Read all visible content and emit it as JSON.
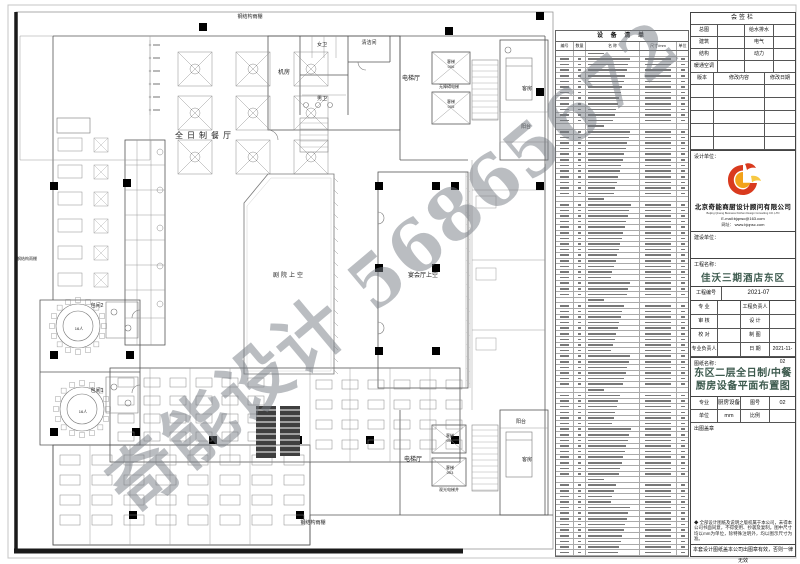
{
  "sheet": {
    "watermark": "奇能设计 56865672"
  },
  "plan": {
    "labels": [
      {
        "t": "钢结构雨棚",
        "x": 250,
        "y": 18,
        "s": 5
      },
      {
        "t": "全日制餐厅",
        "x": 205,
        "y": 138,
        "s": 8,
        "ls": 4
      },
      {
        "t": "机房",
        "x": 284,
        "y": 74,
        "s": 6
      },
      {
        "t": "女卫",
        "x": 322,
        "y": 46,
        "s": 5
      },
      {
        "t": "男卫",
        "x": 322,
        "y": 100,
        "s": 5
      },
      {
        "t": "清洁间",
        "x": 369,
        "y": 44,
        "s": 5
      },
      {
        "t": "电梯厅",
        "x": 411,
        "y": 80,
        "s": 6
      },
      {
        "t": "客梯",
        "x": 451,
        "y": 63,
        "s": 4
      },
      {
        "t": "006",
        "x": 451,
        "y": 68,
        "s": 4
      },
      {
        "t": "无障碍电梯",
        "x": 449,
        "y": 88,
        "s": 4
      },
      {
        "t": "客梯",
        "x": 451,
        "y": 103,
        "s": 4
      },
      {
        "t": "005",
        "x": 451,
        "y": 108,
        "s": 4
      },
      {
        "t": "客房",
        "x": 527,
        "y": 90,
        "s": 5
      },
      {
        "t": "阳台",
        "x": 526,
        "y": 128,
        "s": 5
      },
      {
        "t": "剧院上空",
        "x": 289,
        "y": 277,
        "s": 6,
        "ls": 2
      },
      {
        "t": "宴会厅上空",
        "x": 423,
        "y": 277,
        "s": 6
      },
      {
        "t": "包间2",
        "x": 97,
        "y": 307,
        "s": 5
      },
      {
        "t": "16人",
        "x": 79,
        "y": 330,
        "s": 4
      },
      {
        "t": "包间1",
        "x": 97,
        "y": 392,
        "s": 5
      },
      {
        "t": "16人",
        "x": 83,
        "y": 413,
        "s": 4
      },
      {
        "t": "钢结构雨棚",
        "x": 27,
        "y": 260,
        "s": 4
      },
      {
        "t": "钢结构雨棚",
        "x": 313,
        "y": 524,
        "s": 5
      },
      {
        "t": "电梯厅",
        "x": 413,
        "y": 461,
        "s": 6
      },
      {
        "t": "客梯",
        "x": 450,
        "y": 437,
        "s": 4
      },
      {
        "t": "004",
        "x": 450,
        "y": 442,
        "s": 4
      },
      {
        "t": "客梯",
        "x": 450,
        "y": 469,
        "s": 4
      },
      {
        "t": "003",
        "x": 450,
        "y": 474,
        "s": 4
      },
      {
        "t": "观光电梯井",
        "x": 449,
        "y": 491,
        "s": 4
      },
      {
        "t": "客房",
        "x": 527,
        "y": 461,
        "s": 5
      },
      {
        "t": "阳台",
        "x": 521,
        "y": 423,
        "s": 5
      }
    ]
  },
  "equipment_table": {
    "title": "设 备 清 单",
    "headers": [
      "编号",
      "数量",
      "名  称",
      "尺寸/mm",
      "单位"
    ],
    "row_count": 90,
    "section_rows": [
      0,
      13,
      26,
      44,
      60,
      76
    ]
  },
  "titleblock": {
    "sign_bar": {
      "title": "会签栏",
      "rows": [
        [
          "总图",
          "给水排水"
        ],
        [
          "建筑",
          "电气"
        ],
        [
          "结构",
          "动力"
        ],
        [
          "暖通空调",
          ""
        ]
      ],
      "rev_headers": [
        "版本",
        "修改内容",
        "修改日期"
      ],
      "empty_rev_rows": 5
    },
    "design_unit_label": "设计单位：",
    "company_cn": "北京奇能商厨设计顾问有限公司",
    "company_en": "Beijing Qineng Business Kitchen Design Consulting CO.,LTD",
    "email": "E-mail:bjqnsc@163.com",
    "website": "网址： www.bjqnsc.com",
    "client_label": "建设单位：",
    "project_name_label": "工程名称：",
    "project_name": "佳沃三期酒店东区",
    "project_no_label": "工程编号",
    "project_no": "2021-07",
    "fields": [
      [
        "专  业",
        "",
        "工程负责人",
        ""
      ],
      [
        "审  核",
        "",
        "设  计",
        ""
      ],
      [
        "校  对",
        "",
        "制  图",
        ""
      ],
      [
        "专业负责人",
        "",
        "日  期",
        "2021-11-02"
      ]
    ],
    "drawing_name_label": "图纸名称：",
    "drawing_name": "东区二层全日制/中餐厨房设备平面布置图",
    "spec_rows": [
      [
        "专业",
        "厨房设备",
        "图号",
        "02"
      ],
      [
        "单位",
        "mm",
        "比例",
        ""
      ]
    ],
    "stamp_label": "出图盖章",
    "notice": "◆ 全部设计图纸及说明之版权属于本公司，未得本公司书面同意，不得使用、抄袭及复制。图中尺寸均以mm为单位，除特殊注明外，均以图示尺寸为准。",
    "footer": "本套设计图纸盖本公司出图章有效，否则一律无效"
  },
  "logo_colors": {
    "red": "#d93a1e",
    "orange": "#f2a21a",
    "yellow": "#f7c843"
  }
}
